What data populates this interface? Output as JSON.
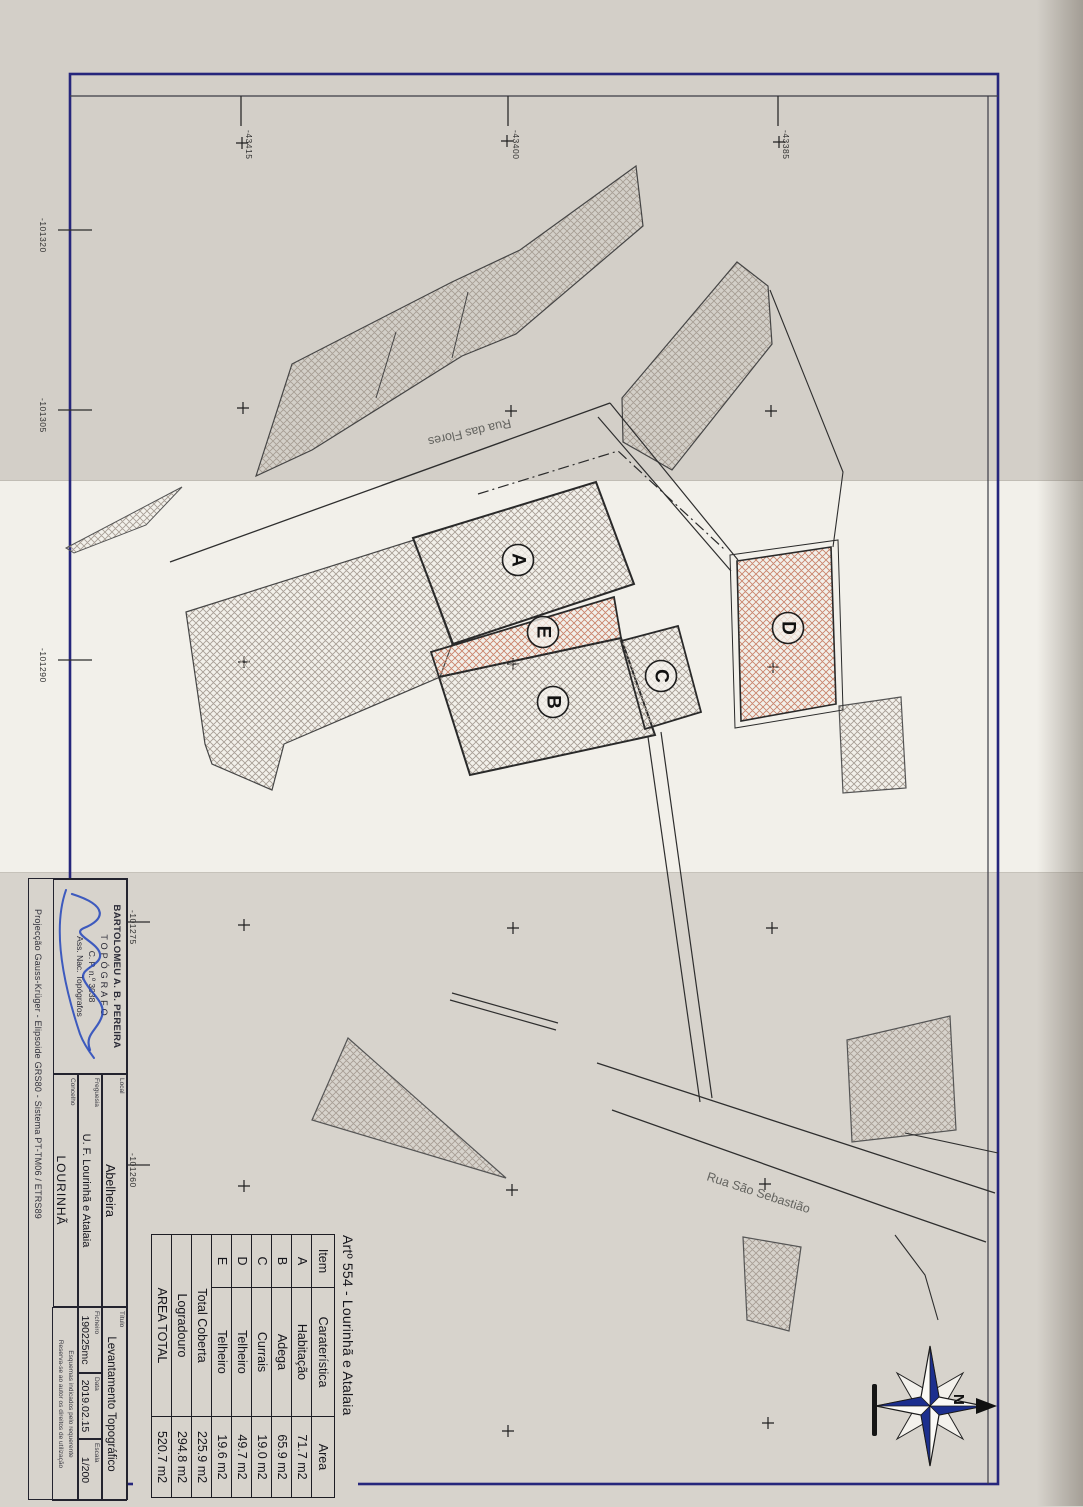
{
  "map": {
    "coord_labels_top": [
      "-43415",
      "-43400",
      "-43385"
    ],
    "coord_labels_left": [
      "-101320",
      "-101305",
      "-101290",
      "-101275",
      "-101260"
    ],
    "street_1": "Rua das Flores",
    "street_2": "Rua São Sebastião",
    "parcel_labels": [
      "A",
      "B",
      "C",
      "D",
      "E"
    ],
    "north_label": "N"
  },
  "table": {
    "title": "Artº 554 - Lourinhã e Atalaia",
    "headers": [
      "Item",
      "Caraterística",
      "Area"
    ],
    "rows": [
      [
        "A",
        "Habitação",
        "71.7 m2"
      ],
      [
        "B",
        "Adega",
        "65.9 m2"
      ],
      [
        "C",
        "Currais",
        "19.0 m2"
      ],
      [
        "D",
        "Telheiro",
        "49.7 m2"
      ],
      [
        "E",
        "Telheiro",
        "19.6 m2"
      ]
    ],
    "totals": [
      [
        "Total Coberta",
        "225.9 m2"
      ],
      [
        "Logradouro",
        "294.8 m2"
      ],
      [
        "AREA TOTAL",
        "520.7 m2"
      ]
    ]
  },
  "title_block": {
    "stamp_line1": "BARTOLOMEU A. B. PEREIRA",
    "stamp_line2": "TOPÓGRAFO",
    "stamp_line3": "C. P. n.º 3038",
    "stamp_line4": "Ass. Nac. Topógrafos",
    "local_label": "Local",
    "local_value": "Abelheira",
    "freguesia_label": "Freguesia",
    "freguesia_value": "U. F. Lourinhã e Atalaia",
    "concelho_label": "Concelho",
    "concelho_value": "LOURINHÃ",
    "titulo_label": "Título",
    "titulo_value": "Levantamento Topográfico",
    "ficheiro_label": "Ficheiro",
    "ficheiro_value": "190225mc",
    "data_label": "Data",
    "data_value": "2019.02.15",
    "escala_label": "Escala",
    "escala_value": "1/200",
    "projection": "Projecção Gauss-Krüger - Elipsoide GRS80 - Sistema PT-TM06 / ETRS89",
    "note_line1": "Esquemas indicados pelo requerente",
    "note_line2": "Reserva-se ao autor os direitos de utilização"
  },
  "colors": {
    "frame": "#26267c",
    "hatch_gray": "#a79e94",
    "hatch_pink": "#c9836b",
    "signature_blue": "#2244bb",
    "compass_blue": "#1c2f8e"
  }
}
